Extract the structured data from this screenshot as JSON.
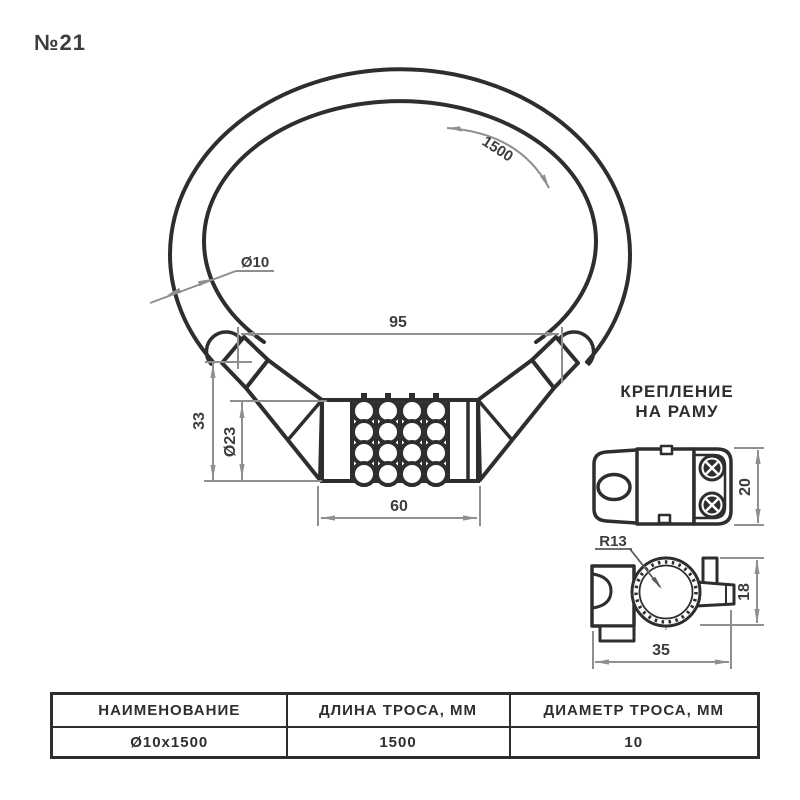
{
  "title": "№21",
  "colors": {
    "line": "#2e2e2e",
    "dim": "#8f8f8f",
    "dim_text": "#3d3d3d"
  },
  "cable": {
    "length_dim": "1500",
    "diameter_label": "Ø10"
  },
  "lock": {
    "width_dim": "95",
    "height_dim": "33",
    "body_diameter_dim": "Ø23",
    "body_width_dim": "60"
  },
  "mount": {
    "label_line1": "КРЕПЛЕНИЕ",
    "label_line2": "НА РАМУ",
    "radius_dim": "R13",
    "depth_dim": "20",
    "height_dim": "18",
    "width_dim": "35"
  },
  "table": {
    "headers": [
      "НАИМЕНОВАНИЕ",
      "ДЛИНА ТРОСА, ММ",
      "ДИАМЕТР ТРОСА, ММ"
    ],
    "rows": [
      [
        "Ø10x1500",
        "1500",
        "10"
      ]
    ]
  }
}
